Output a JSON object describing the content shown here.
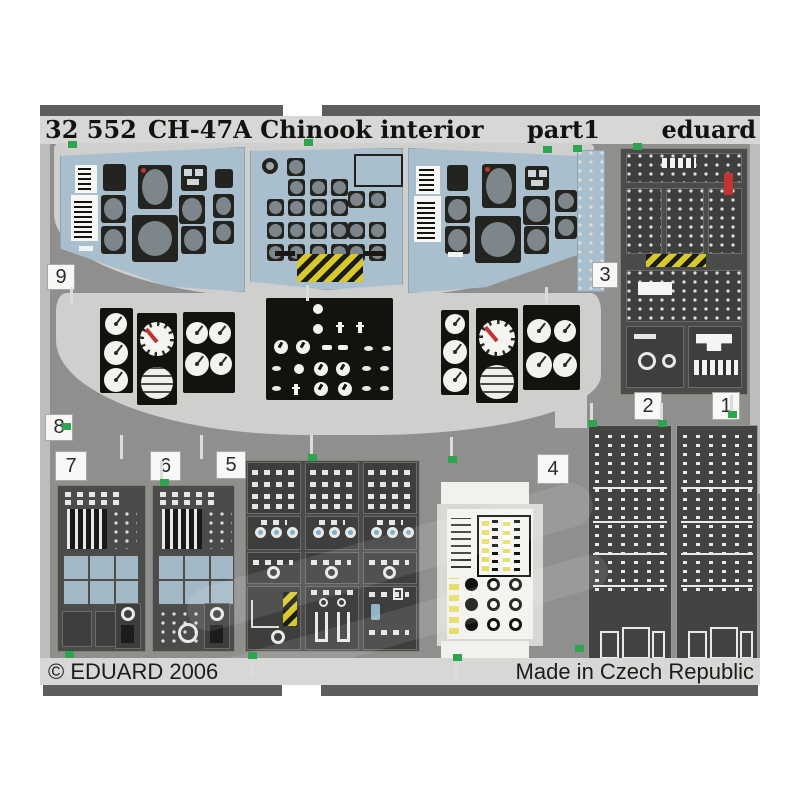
{
  "product_photo": {
    "header": {
      "catalog_number": "32 552",
      "title": "CH-47A Chinook interior",
      "part_label": "part1",
      "brand": "eduard"
    },
    "footer": {
      "copyright": "© EDUARD 2006",
      "origin": "Made in Czech Republic"
    },
    "part_numbers": {
      "p1": "1",
      "p2": "2",
      "p3": "3",
      "p4": "4",
      "p5": "5",
      "p6": "6",
      "p7": "7",
      "p8": "8",
      "p9": "9"
    },
    "colors": {
      "photo_backdrop": "#8f8f8d",
      "sheet_light": "#cfcfcd",
      "panel_blue": "#a9bfcd",
      "panel_dark": "#4b4b49",
      "instrument_black": "#23231f",
      "hazard_yellow": "#d9c92c",
      "warning_red": "#c03434",
      "tab_green": "#2ea44e",
      "bar_gray": "#5d5d5b",
      "strip_gray": "#d7d7d5"
    }
  }
}
